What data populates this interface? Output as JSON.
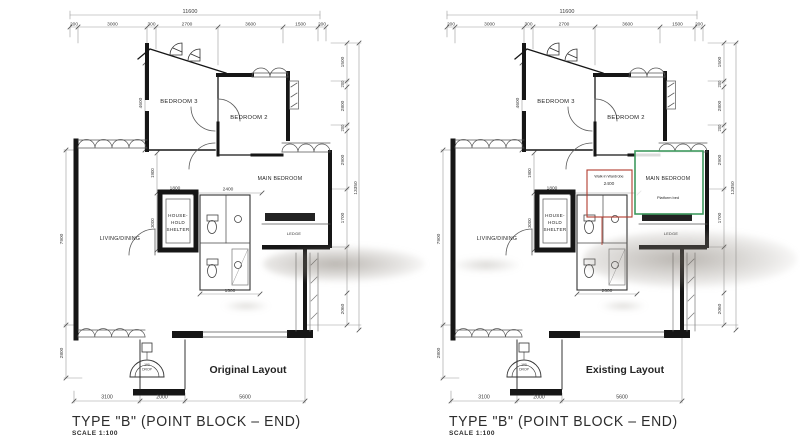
{
  "plans": [
    {
      "title": "TYPE \"B\" (POINT BLOCK – END)",
      "scale_label": "SCALE  1:100",
      "layout_label": "Original Layout",
      "layout_label_color": "#2e96b8",
      "dims": {
        "overall_width": "11600",
        "top": [
          "200",
          "3000",
          "300",
          "2700",
          "3600",
          "1500",
          "200"
        ],
        "right": [
          "1500",
          "200",
          "2800",
          "200",
          "2900",
          "1700",
          "2060"
        ],
        "overall_height": "13350",
        "left_upper": "7900",
        "left_lower": "2800",
        "bedroom3_height": "4600",
        "hall": "1900",
        "shelter_height": "3000",
        "shelter_width": "1800",
        "main_bedroom": "2400",
        "kitchen": "1500",
        "bottom": [
          "3100",
          "2000",
          "5600"
        ],
        "drop_note": [
          "100",
          "DROP"
        ]
      },
      "rooms": {
        "bedroom3": "BEDROOM 3",
        "bedroom2": "BEDROOM 2",
        "main_bedroom": "MAIN BEDROOM",
        "living": "LIVING/DINING",
        "shelter": [
          "HOUSE-",
          "HOLD",
          "SHELTER"
        ],
        "ledge": "LEDGE"
      }
    },
    {
      "title": "TYPE \"B\" (POINT BLOCK – END)",
      "scale_label": "SCALE  1:100",
      "layout_label": "Existing Layout",
      "layout_label_color": "#d99a3e",
      "dims": {
        "overall_width": "11600",
        "top": [
          "200",
          "3000",
          "300",
          "2700",
          "3600",
          "1500",
          "200"
        ],
        "right": [
          "1500",
          "200",
          "2800",
          "200",
          "2900",
          "1700",
          "2060"
        ],
        "overall_height": "13350",
        "left_upper": "7900",
        "left_lower": "2800",
        "bedroom3_height": "4600",
        "hall": "1900",
        "shelter_height": "3000",
        "shelter_width": "1800",
        "main_bedroom": "2400",
        "kitchen": "2600",
        "bottom": [
          "3100",
          "2000",
          "5600"
        ],
        "drop_note": [
          "100",
          "DROP"
        ]
      },
      "rooms": {
        "bedroom3": "BEDROOM 3",
        "bedroom2": "BEDROOM 2",
        "main_bedroom": "MAIN BEDROOM",
        "living": "LIVING/DINING",
        "shelter": [
          "HOUSE-",
          "HOLD",
          "SHELTER"
        ],
        "ledge": "LEDGE"
      },
      "annotations": {
        "wardrobe": "Walk-in Wardrobe",
        "wardrobe_color": "#b23b2e",
        "platform_bed": "Platform bed",
        "platform_bed_color": "#3f9a5f"
      }
    }
  ]
}
